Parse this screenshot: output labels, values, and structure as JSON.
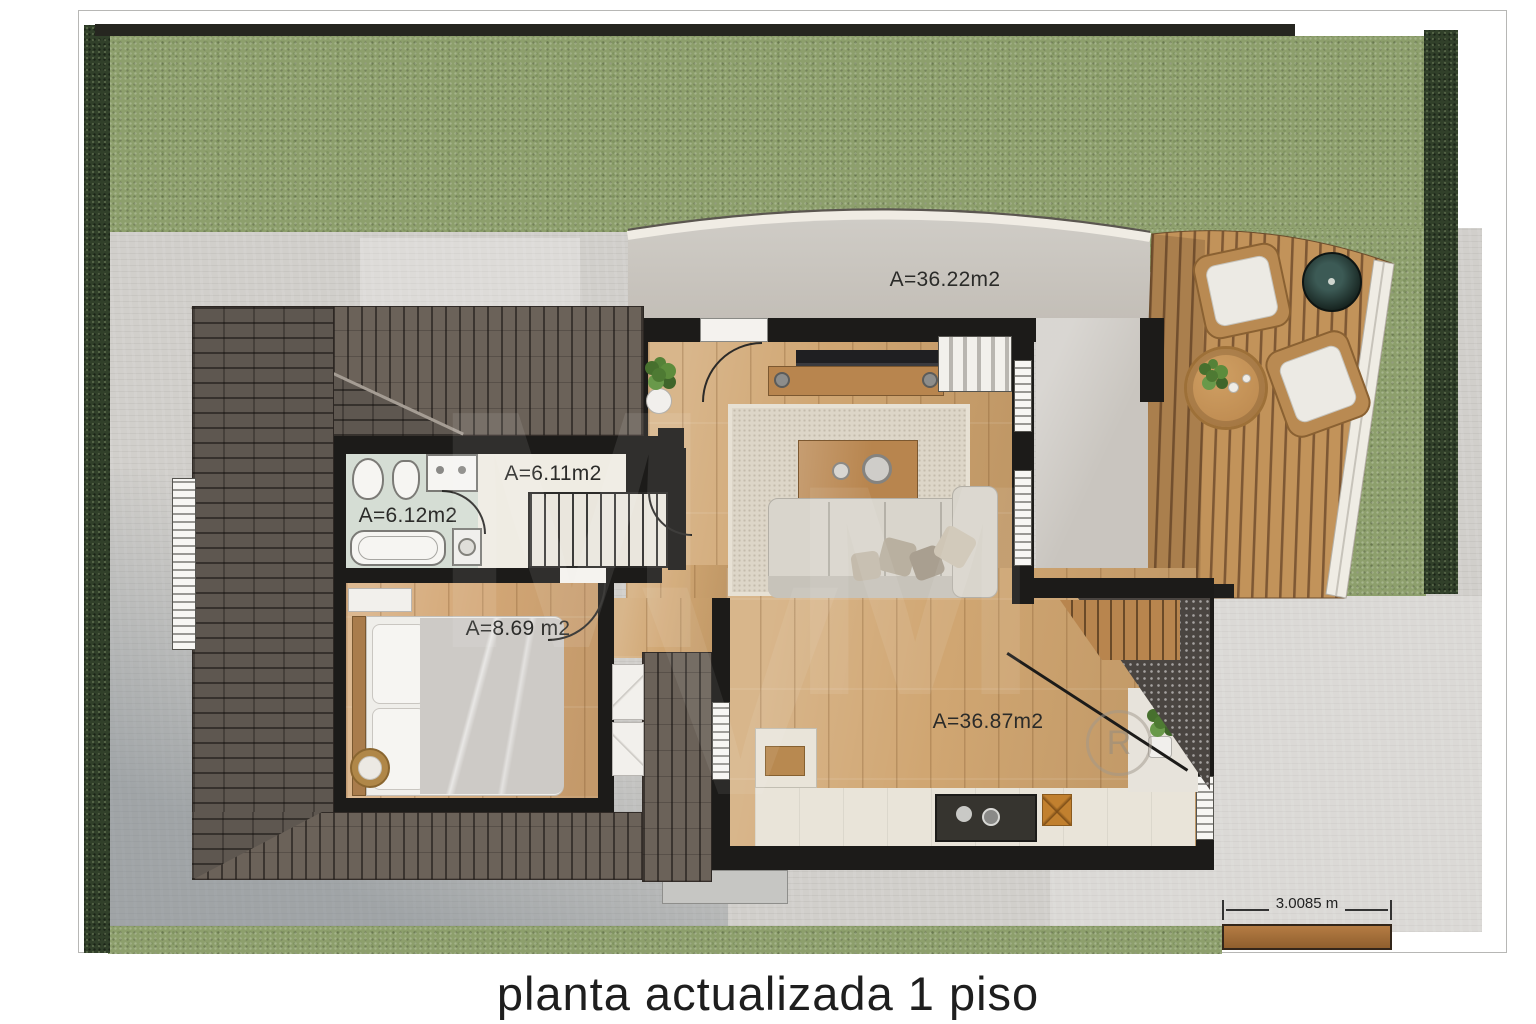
{
  "caption": "planta actualizada 1 piso",
  "areas": {
    "terrace": "A=36.22m2",
    "stair_hall": "A=6.11m2",
    "bathroom": "A=6.12m2",
    "bedroom": "A=8.69 m2",
    "main_room": "A=36.87m2"
  },
  "scale_bar": {
    "label": "3.0085 m"
  },
  "watermark": {
    "symbol": "R",
    "letters": [
      "M",
      "V",
      "M"
    ]
  },
  "colors": {
    "grass": "#8d9f6c",
    "hedge": "#31402a",
    "paving": "#d1cfcb",
    "roof_tiles": "#5e5750",
    "walls": "#1c1b19",
    "wood_floor": "#d0a672",
    "deck_wood": "#c2935a",
    "terrace_concrete": "#c9c5bf"
  }
}
